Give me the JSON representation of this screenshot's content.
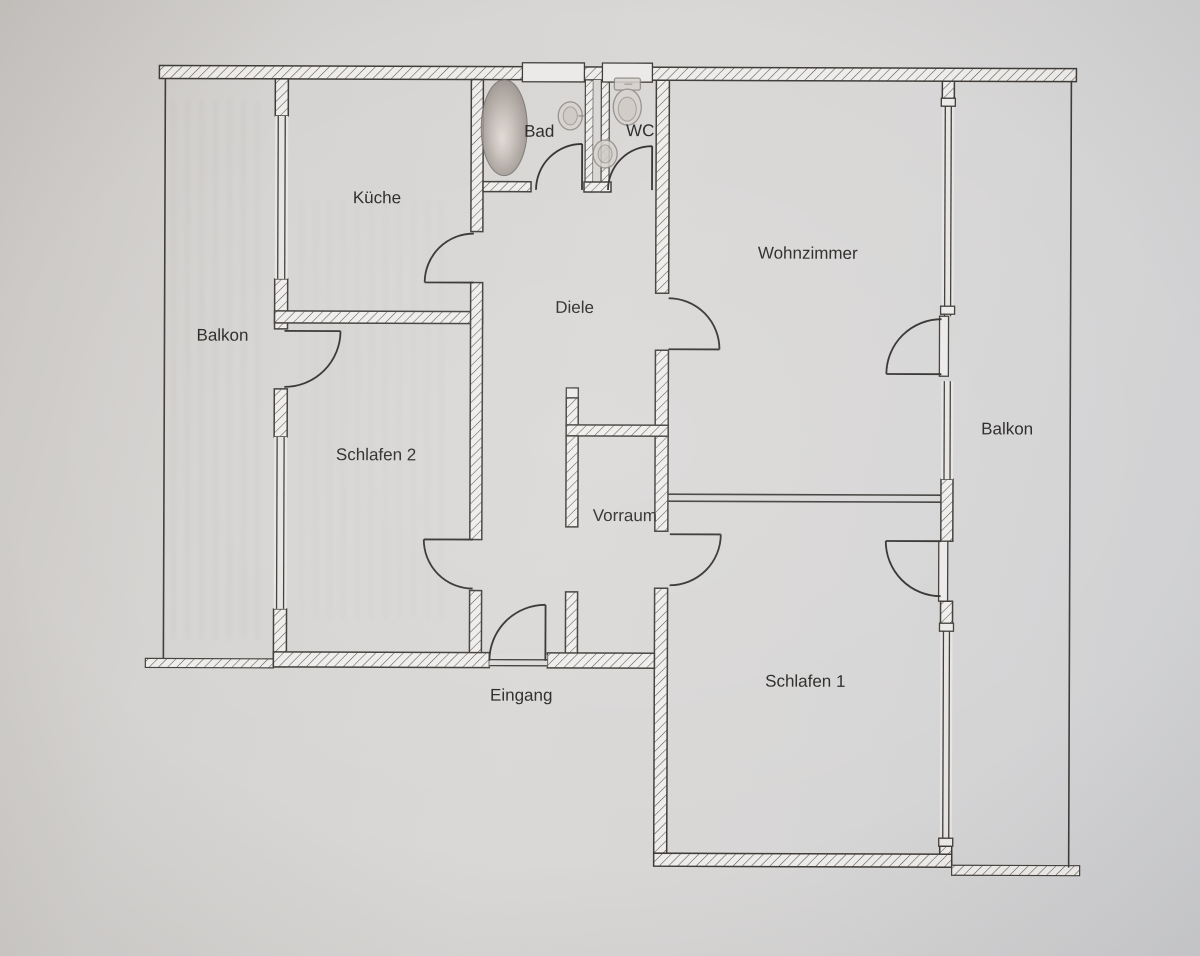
{
  "plan": {
    "type": "apartment-floor-plan",
    "rooms": [
      {
        "id": "kueche",
        "label": "Küche"
      },
      {
        "id": "bad",
        "label": "Bad"
      },
      {
        "id": "wc",
        "label": "WC"
      },
      {
        "id": "wohnzimmer",
        "label": "Wohnzimmer"
      },
      {
        "id": "diele",
        "label": "Diele"
      },
      {
        "id": "balkon-links",
        "label": "Balkon"
      },
      {
        "id": "schlafen-2",
        "label": "Schlafen 2"
      },
      {
        "id": "vorraum",
        "label": "Vorraum"
      },
      {
        "id": "balkon-rechts",
        "label": "Balkon"
      },
      {
        "id": "schlafen-1",
        "label": "Schlafen 1"
      },
      {
        "id": "eingang",
        "label": "Eingang"
      }
    ],
    "colors": {
      "paper": "#d6d4d2",
      "wall_fill": "#efedeb",
      "line": "#3f3c39",
      "text": "#2b2927",
      "tub_rim": "#857c76",
      "tub_center": "#e2dcd6"
    }
  }
}
